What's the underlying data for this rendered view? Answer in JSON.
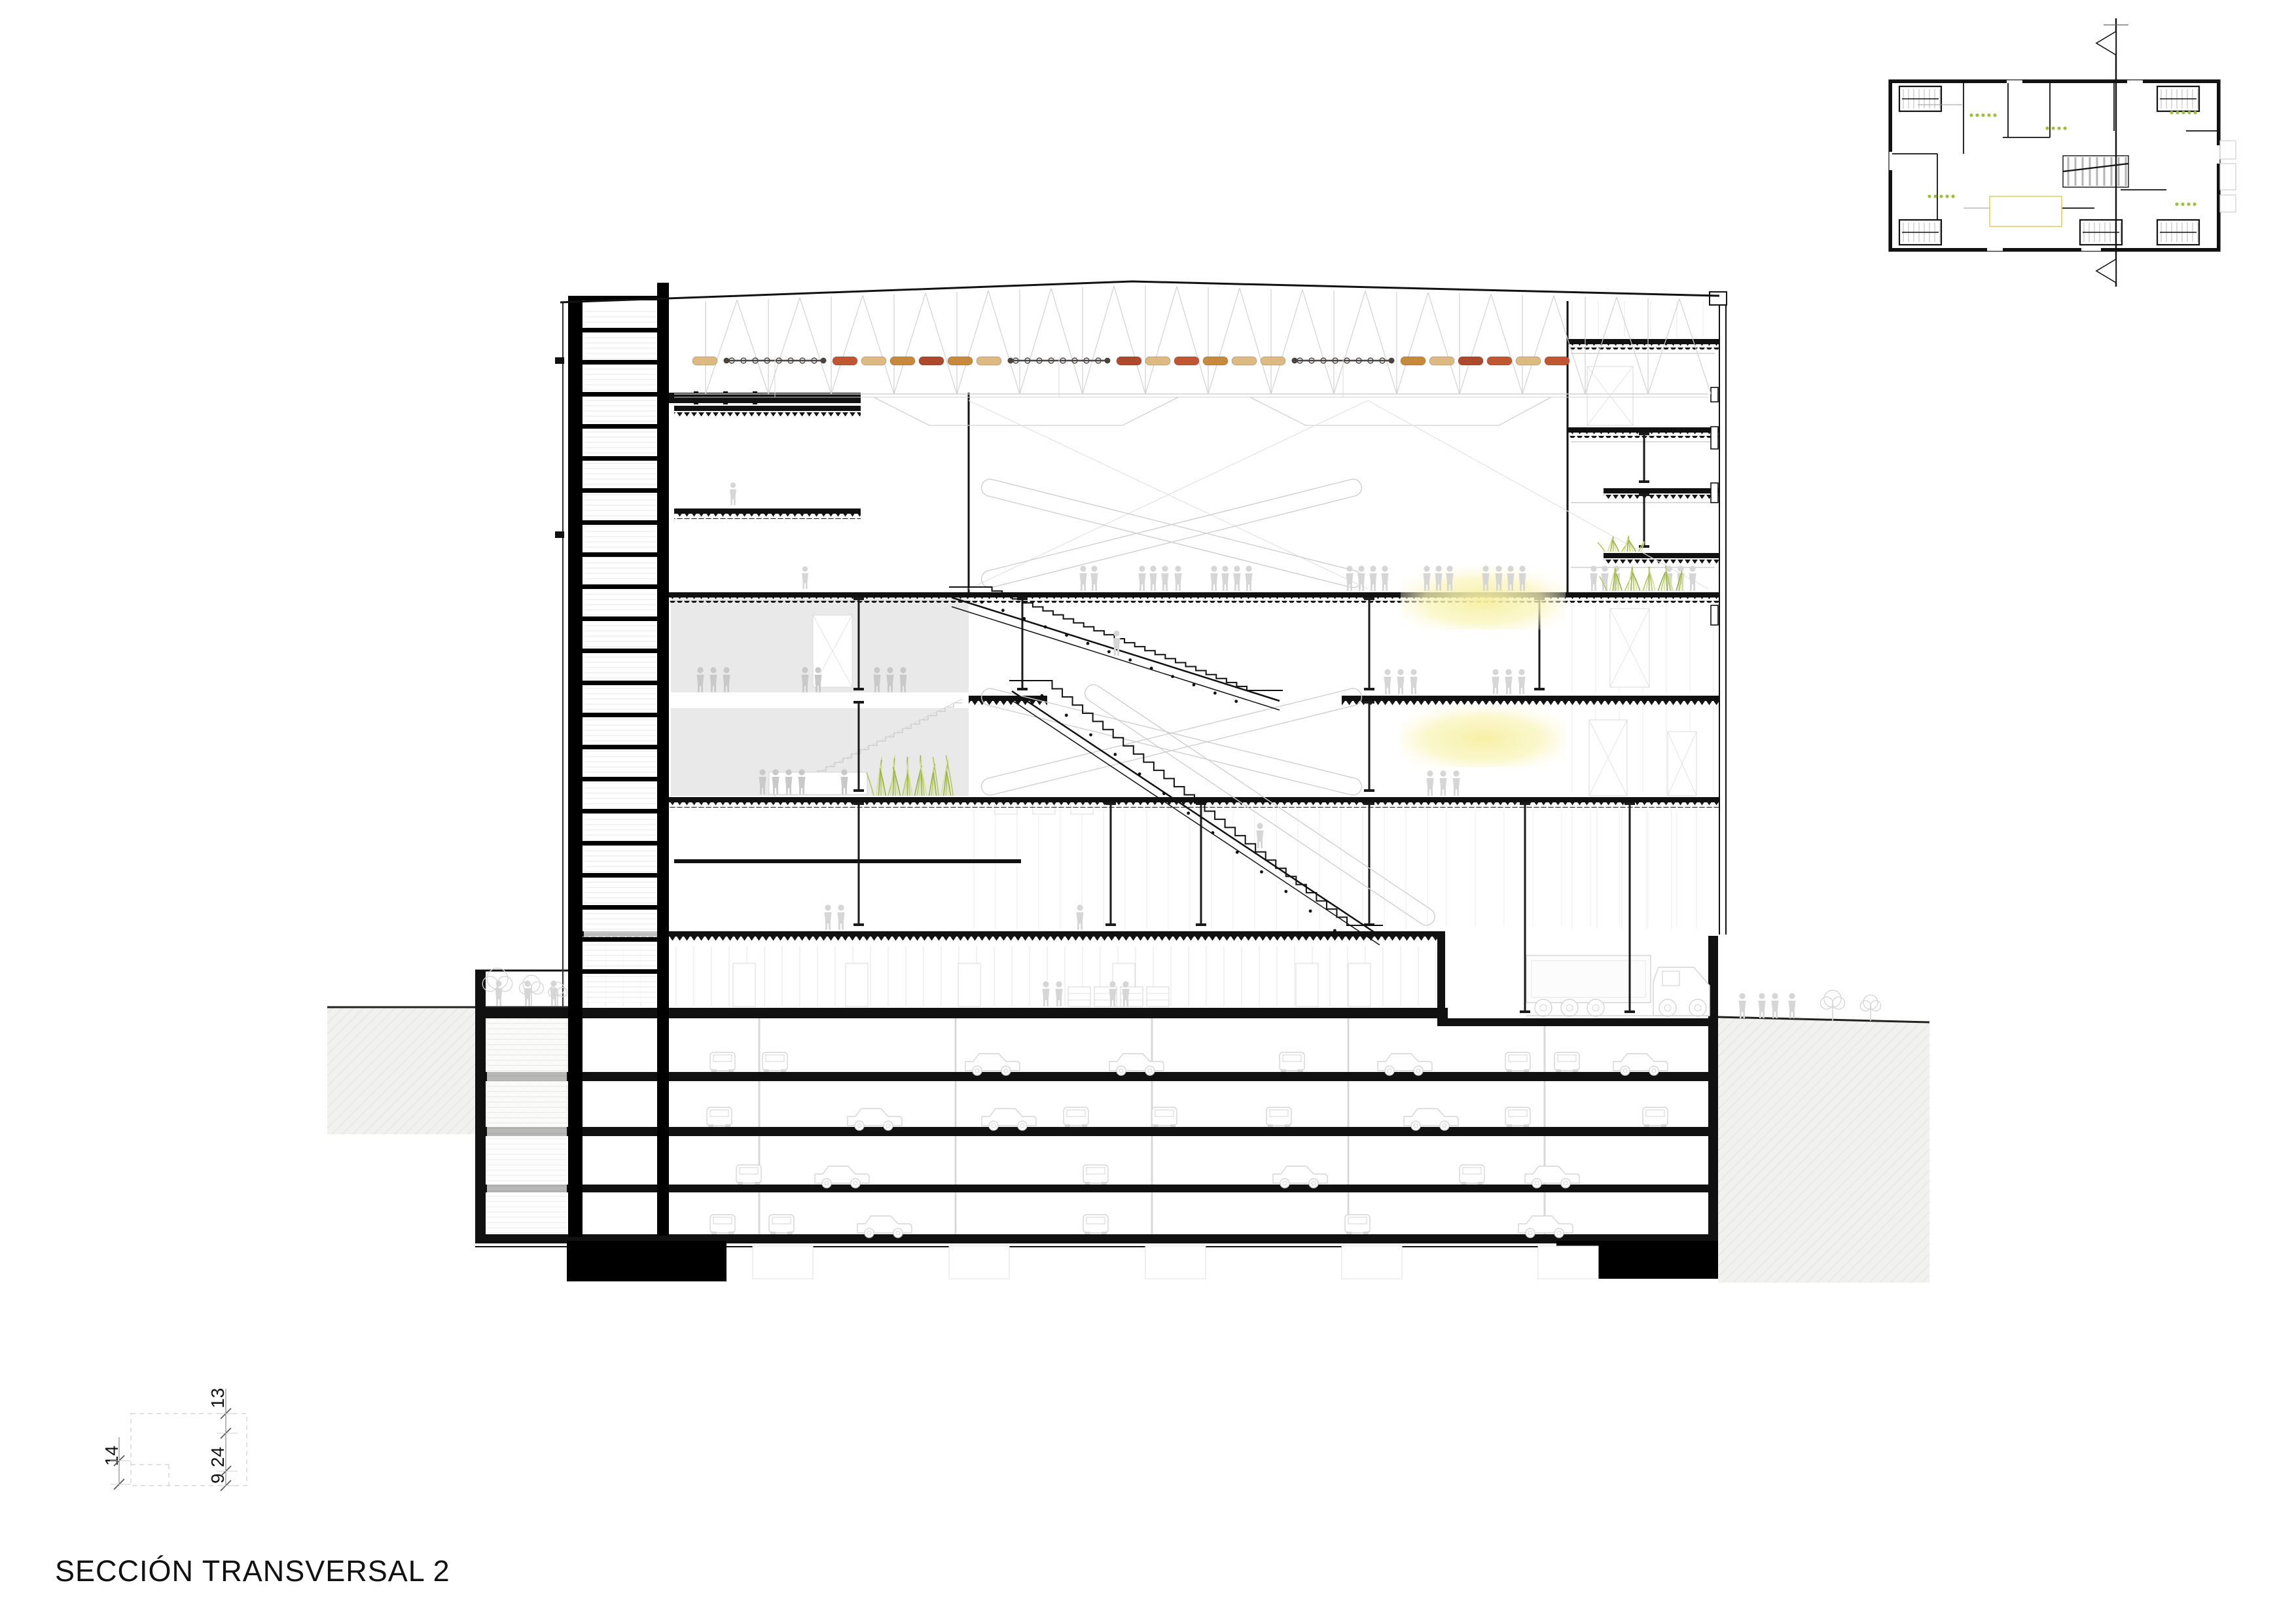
{
  "drawing": {
    "kind": "architectural-cross-section"
  },
  "title": {
    "text": "SECCIÓN TRANSVERSAL 2"
  },
  "dimensions": {
    "left": "14",
    "right": [
      "13",
      "24",
      "9"
    ]
  },
  "palette": {
    "ink": "#111111",
    "light_line": "#c9c9c9",
    "faint_line": "#e4e4e2",
    "figure_gray": "#d6d6d6",
    "figure_dark": "#c9c9c9",
    "ground_fill": "#f1f1ef",
    "ground_hatch": "#e3e3e1",
    "hall_fill": "#e9e9e9",
    "screen_yellow": "#f7f1a9",
    "plant_green_1": "#b5c75e",
    "plant_green_2": "#d4df97",
    "plant_green_3": "#97b243",
    "plan_dot_green": "#9ebf3c",
    "band_tan": "#dcba82",
    "band_ochre": "#c78a3c",
    "band_red": "#c05634",
    "band_dark": "#ad492d",
    "band_rod": "#4a4440"
  },
  "baffle_band": {
    "groups": [
      {
        "type": "pills",
        "colors": [
          "tan"
        ]
      },
      {
        "type": "rod"
      },
      {
        "type": "pills",
        "colors": [
          "red",
          "tan",
          "ochre",
          "dark",
          "ochre",
          "tan"
        ]
      },
      {
        "type": "rod"
      },
      {
        "type": "pills",
        "colors": [
          "dark",
          "tan",
          "red",
          "ochre",
          "tan",
          "tan"
        ]
      },
      {
        "type": "rod"
      },
      {
        "type": "pills",
        "colors": [
          "ochre",
          "tan",
          "dark",
          "red",
          "tan",
          "red"
        ]
      }
    ]
  }
}
